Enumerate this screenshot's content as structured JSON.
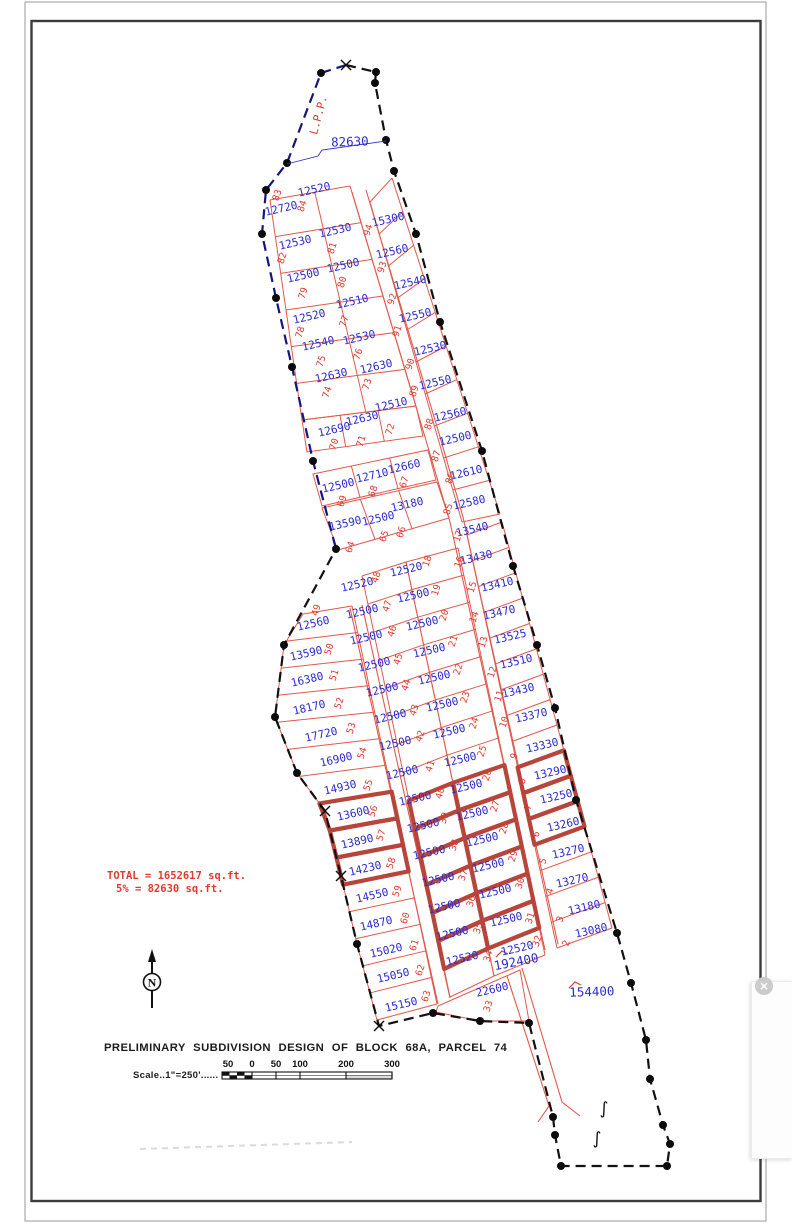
{
  "doc": {
    "title": "PRELIMINARY SUBDIVISION DESIGN OF BLOCK 68A, PARCEL 74",
    "scale_label": "Scale..1\"=250'......",
    "total_line1": "TOTAL = 1652617 sq.ft.",
    "total_line2": "5% = 82630 sq.ft.",
    "north_letter": "N",
    "lpp_label": "L.P.P.",
    "reserve_area": "82630",
    "road_parcel_area": "192400",
    "south_parcel_area": "154400",
    "close_icon": "×",
    "break_symbol": "∫"
  },
  "colors": {
    "line_red": "#e0594e",
    "bold_red": "#b8453b",
    "num_red": "#e03a30",
    "area_blue": "#2b2bcc",
    "boundary_black": "#111111",
    "boundary_blue": "#15157e",
    "border_dark": "#3b3b3b",
    "border_gray": "#9a9a9a"
  },
  "scalebar": {
    "labels": [
      "50",
      "0",
      "50",
      "100",
      "200",
      "300"
    ],
    "label_x": [
      228,
      252,
      276,
      300,
      346,
      392
    ],
    "tick_x": [
      252,
      276,
      300,
      346,
      392
    ],
    "x0": 222,
    "x1": 392,
    "y": 1072,
    "h": 7
  },
  "lots_key": [
    "lot_no",
    "area_sqft",
    "area_x",
    "area_y",
    "num_x",
    "num_y",
    "bold"
  ],
  "lots": [
    [
      "83",
      "12720",
      282,
      212,
      280,
      196,
      0
    ],
    [
      "84",
      "12520",
      315,
      193,
      305,
      207,
      0
    ],
    [
      "82",
      "12530",
      296,
      246,
      285,
      259,
      0
    ],
    [
      "81",
      "12530",
      336,
      234,
      335,
      249,
      0
    ],
    [
      "79",
      "12500",
      304,
      279,
      306,
      294,
      0
    ],
    [
      "80",
      "12500",
      344,
      269,
      345,
      283,
      0
    ],
    [
      "78",
      "12520",
      310,
      320,
      303,
      333,
      0
    ],
    [
      "77",
      "12510",
      353,
      305,
      347,
      322,
      0
    ],
    [
      "75",
      "12540",
      319,
      347,
      324,
      362,
      0
    ],
    [
      "76",
      "12530",
      360,
      341,
      361,
      355,
      0
    ],
    [
      "74",
      "12630",
      332,
      379,
      330,
      393,
      0
    ],
    [
      "73",
      "12630",
      377,
      370,
      370,
      385,
      0
    ],
    [
      "70",
      "12690",
      335,
      433,
      337,
      445,
      0
    ],
    [
      "71",
      "12630",
      363,
      422,
      364,
      442,
      0
    ],
    [
      "72",
      "12510",
      392,
      408,
      393,
      430,
      0
    ],
    [
      "69",
      "12500",
      339,
      489,
      345,
      502,
      0
    ],
    [
      "68",
      "12710",
      373,
      479,
      376,
      492,
      0
    ],
    [
      "67",
      "12660",
      405,
      470,
      407,
      483,
      0
    ],
    [
      "64",
      "13590",
      346,
      527,
      353,
      548,
      0
    ],
    [
      "65",
      "12500",
      379,
      522,
      387,
      537,
      0
    ],
    [
      "66",
      "13180",
      408,
      508,
      404,
      533,
      0
    ],
    [
      "94",
      "15300",
      389,
      223,
      371,
      231,
      0
    ],
    [
      "93",
      "12560",
      393,
      255,
      385,
      268,
      0
    ],
    [
      "92",
      "12540",
      411,
      286,
      395,
      300,
      0
    ],
    [
      "91",
      "12550",
      416,
      319,
      400,
      332,
      0
    ],
    [
      "90",
      "12530",
      431,
      352,
      413,
      365,
      0
    ],
    [
      "89",
      "12550",
      436,
      386,
      417,
      392,
      0
    ],
    [
      "88",
      "12560",
      451,
      418,
      432,
      425,
      0
    ],
    [
      "87",
      "12500",
      456,
      442,
      439,
      457,
      0
    ],
    [
      "86",
      "12610",
      467,
      476,
      453,
      479,
      0
    ],
    [
      "85",
      "12580",
      470,
      506,
      451,
      510,
      0
    ],
    [
      "17",
      "13540",
      473,
      533,
      461,
      537,
      0
    ],
    [
      "16",
      "13430",
      477,
      561,
      462,
      563,
      0
    ],
    [
      "15",
      "13410",
      498,
      588,
      475,
      588,
      0
    ],
    [
      "14",
      "13470",
      500,
      616,
      477,
      618,
      0
    ],
    [
      "13",
      "13525",
      511,
      640,
      486,
      643,
      0
    ],
    [
      "12",
      "13510",
      517,
      665,
      495,
      673,
      0
    ],
    [
      "11",
      "13430",
      519,
      694,
      502,
      697,
      0
    ],
    [
      "10",
      "13370",
      532,
      719,
      507,
      723,
      0
    ],
    [
      "9",
      "13330",
      543,
      749,
      517,
      757,
      0
    ],
    [
      "8",
      "13290",
      551,
      776,
      525,
      782,
      1
    ],
    [
      "7",
      "13250",
      557,
      800,
      531,
      808,
      1
    ],
    [
      "6",
      "13260",
      564,
      828,
      539,
      835,
      1
    ],
    [
      "5",
      "13270",
      569,
      855,
      546,
      862,
      0
    ],
    [
      "4",
      "13270",
      573,
      884,
      553,
      892,
      0
    ],
    [
      "3",
      "13180",
      585,
      911,
      563,
      920,
      0
    ],
    [
      "2",
      "13080",
      592,
      934,
      569,
      944,
      0
    ],
    [
      "49",
      "12560",
      314,
      627,
      319,
      611,
      0
    ],
    [
      "50",
      "13590",
      307,
      657,
      332,
      650,
      0
    ],
    [
      "51",
      "16380",
      308,
      683,
      337,
      676,
      0
    ],
    [
      "52",
      "18170",
      310,
      711,
      342,
      704,
      0
    ],
    [
      "53",
      "17720",
      322,
      738,
      354,
      729,
      0
    ],
    [
      "54",
      "16900",
      337,
      763,
      365,
      754,
      0
    ],
    [
      "55",
      "14930",
      341,
      791,
      371,
      786,
      0
    ],
    [
      "56",
      "13600",
      354,
      817,
      376,
      812,
      1
    ],
    [
      "57",
      "13890",
      358,
      845,
      384,
      836,
      1
    ],
    [
      "58",
      "14230",
      366,
      872,
      394,
      864,
      1
    ],
    [
      "59",
      "14550",
      373,
      899,
      400,
      892,
      0
    ],
    [
      "60",
      "14870",
      377,
      927,
      408,
      919,
      0
    ],
    [
      "61",
      "15020",
      387,
      954,
      417,
      946,
      0
    ],
    [
      "62",
      "15050",
      394,
      979,
      423,
      971,
      0
    ],
    [
      "63",
      "15150",
      402,
      1008,
      429,
      997,
      0
    ],
    [
      "48",
      "12520",
      358,
      588,
      379,
      578,
      0
    ],
    [
      "47",
      "12500",
      363,
      615,
      390,
      607,
      0
    ],
    [
      "46",
      "12500",
      367,
      641,
      395,
      632,
      0
    ],
    [
      "45",
      "12500",
      375,
      668,
      401,
      660,
      0
    ],
    [
      "44",
      "12500",
      383,
      693,
      409,
      686,
      0
    ],
    [
      "43",
      "12500",
      391,
      720,
      417,
      711,
      0
    ],
    [
      "42",
      "12500",
      396,
      747,
      423,
      737,
      0
    ],
    [
      "41",
      "12500",
      403,
      776,
      433,
      767,
      0
    ],
    [
      "40",
      "12500",
      416,
      802,
      443,
      794,
      1
    ],
    [
      "39",
      "12500",
      424,
      829,
      447,
      819,
      1
    ],
    [
      "38",
      "12500",
      430,
      856,
      457,
      846,
      1
    ],
    [
      "37",
      "12500",
      439,
      883,
      466,
      876,
      1
    ],
    [
      "36",
      "12500",
      445,
      910,
      474,
      902,
      1
    ],
    [
      "35",
      "12500",
      453,
      937,
      481,
      929,
      1
    ],
    [
      "34",
      "12520",
      463,
      962,
      491,
      957,
      0
    ],
    [
      "18",
      "12520",
      407,
      573,
      430,
      562,
      0
    ],
    [
      "19",
      "12500",
      414,
      599,
      439,
      591,
      0
    ],
    [
      "20",
      "12500",
      423,
      627,
      447,
      616,
      0
    ],
    [
      "21",
      "12500",
      430,
      654,
      456,
      642,
      0
    ],
    [
      "22",
      "12500",
      435,
      681,
      461,
      670,
      0
    ],
    [
      "23",
      "12500",
      443,
      708,
      468,
      698,
      0
    ],
    [
      "24",
      "12500",
      450,
      735,
      477,
      724,
      0
    ],
    [
      "25",
      "12500",
      461,
      763,
      485,
      752,
      0
    ],
    [
      "26",
      "12500",
      467,
      790,
      490,
      776,
      1
    ],
    [
      "27",
      "12500",
      473,
      817,
      498,
      807,
      1
    ],
    [
      "28",
      "12500",
      483,
      843,
      507,
      829,
      1
    ],
    [
      "29",
      "12500",
      489,
      869,
      516,
      857,
      1
    ],
    [
      "30",
      "12500",
      496,
      895,
      523,
      884,
      1
    ],
    [
      "31",
      "12500",
      507,
      923,
      533,
      919,
      1
    ],
    [
      "32",
      "12520",
      518,
      952,
      540,
      942,
      0
    ],
    [
      "33",
      "22600",
      493,
      993,
      491,
      1007,
      0
    ]
  ],
  "geometry": {
    "boundary_black": [
      [
        346,
        65
      ],
      [
        376,
        72
      ],
      [
        375,
        83
      ],
      [
        386,
        140
      ],
      [
        394,
        171
      ],
      [
        416,
        234
      ],
      [
        440,
        322
      ],
      [
        482,
        451
      ],
      [
        513,
        566
      ],
      [
        537,
        645
      ],
      [
        555,
        708
      ],
      [
        576,
        800
      ],
      [
        617,
        933
      ],
      [
        631,
        983
      ],
      [
        646,
        1040
      ],
      [
        650,
        1079
      ],
      [
        663,
        1125
      ],
      [
        670,
        1144
      ],
      [
        667,
        1166
      ],
      [
        561,
        1166
      ],
      [
        555,
        1135
      ],
      [
        553,
        1117
      ],
      [
        529,
        1023
      ],
      [
        480,
        1021
      ],
      [
        433,
        1013
      ],
      [
        379,
        1026
      ],
      [
        357,
        944
      ],
      [
        341,
        876
      ],
      [
        325,
        811
      ],
      [
        297,
        773
      ],
      [
        275,
        717
      ],
      [
        284,
        645
      ],
      [
        336,
        549
      ]
    ],
    "boundary_blue": [
      [
        346,
        65
      ],
      [
        321,
        73
      ],
      [
        287,
        163
      ],
      [
        266,
        190
      ],
      [
        262,
        234
      ],
      [
        276,
        298
      ],
      [
        292,
        367
      ],
      [
        313,
        461
      ],
      [
        336,
        549
      ]
    ],
    "dots": [
      [
        321,
        73
      ],
      [
        376,
        72
      ],
      [
        375,
        83
      ],
      [
        386,
        140
      ],
      [
        394,
        171
      ],
      [
        416,
        234
      ],
      [
        440,
        322
      ],
      [
        482,
        451
      ],
      [
        513,
        566
      ],
      [
        537,
        645
      ],
      [
        555,
        708
      ],
      [
        576,
        800
      ],
      [
        617,
        933
      ],
      [
        631,
        983
      ],
      [
        646,
        1040
      ],
      [
        650,
        1079
      ],
      [
        663,
        1125
      ],
      [
        670,
        1144
      ],
      [
        667,
        1166
      ],
      [
        561,
        1166
      ],
      [
        555,
        1135
      ],
      [
        553,
        1117
      ],
      [
        529,
        1023
      ],
      [
        480,
        1021
      ],
      [
        433,
        1013
      ],
      [
        357,
        944
      ],
      [
        297,
        773
      ],
      [
        275,
        717
      ],
      [
        284,
        645
      ],
      [
        336,
        549
      ],
      [
        313,
        461
      ],
      [
        292,
        367
      ],
      [
        276,
        298
      ],
      [
        262,
        234
      ],
      [
        266,
        190
      ],
      [
        287,
        163
      ]
    ],
    "xmarks": [
      [
        346,
        65
      ],
      [
        379,
        1026
      ],
      [
        341,
        876
      ],
      [
        325,
        811
      ]
    ],
    "strips": [
      {
        "id": "u12",
        "L0": [
          270,
          200
        ],
        "L1": [
          302,
          420
        ],
        "R0": [
          350,
          186
        ],
        "R1": [
          416,
          406
        ],
        "n": 6,
        "divider": 0.56
      },
      {
        "id": "r3",
        "quad": [
          [
            302,
            420
          ],
          [
            416,
            406
          ],
          [
            423,
            436
          ],
          [
            307,
            452
          ]
        ],
        "cols": 3
      },
      {
        "id": "r4",
        "quad": [
          [
            313,
            474
          ],
          [
            428,
            450
          ],
          [
            436,
            480
          ],
          [
            322,
            506
          ]
        ],
        "cols": 3
      },
      {
        "id": "r5",
        "quad": [
          [
            322,
            508
          ],
          [
            437,
            482
          ],
          [
            449,
            518
          ],
          [
            338,
            550
          ]
        ],
        "cols": 3
      },
      {
        "id": "s3",
        "L0": [
          370,
          202
        ],
        "L1": [
          462,
          522
        ],
        "R0": [
          392,
          178
        ],
        "R1": [
          500,
          514
        ],
        "n": 10
      },
      {
        "id": "s4",
        "L0": [
          467,
          535
        ],
        "L1": [
          557,
          948
        ],
        "R0": [
          502,
          522
        ],
        "R1": [
          612,
          928
        ],
        "n": 16,
        "bold": [
          9,
          10,
          11
        ]
      },
      {
        "id": "s5",
        "leftPoly": [
          [
            303,
            614
          ],
          [
            284,
            645
          ],
          [
            275,
            717
          ],
          [
            297,
            773
          ],
          [
            325,
            811
          ],
          [
            341,
            876
          ],
          [
            357,
            944
          ],
          [
            377,
            1020
          ]
        ],
        "R0": [
          352,
          606
        ],
        "R1": [
          437,
          1004
        ],
        "n": 15,
        "bold": [
          7,
          8,
          9
        ]
      },
      {
        "id": "s6",
        "L0": [
          362,
          576
        ],
        "L1": [
          450,
          997
        ],
        "R0": [
          406,
          562
        ],
        "R1": [
          494,
          976
        ],
        "n": 15,
        "bold": [
          8,
          9,
          10,
          11,
          12,
          13
        ]
      },
      {
        "id": "s7",
        "L0": [
          406,
          562
        ],
        "L1": [
          494,
          976
        ],
        "R0": [
          458,
          548
        ],
        "R1": [
          545,
          955
        ],
        "n": 15,
        "bold": [
          8,
          9,
          10,
          11,
          12,
          13
        ]
      }
    ],
    "streets": [
      [
        [
          352,
          192
        ],
        [
          425,
          437
        ],
        [
          450,
          522
        ],
        [
          545,
          950
        ]
      ],
      [
        [
          366,
          190
        ],
        [
          438,
          430
        ],
        [
          463,
          517
        ],
        [
          558,
          944
        ]
      ],
      [
        [
          350,
          608
        ],
        [
          438,
          1004
        ]
      ],
      [
        [
          362,
          605
        ],
        [
          450,
          998
        ]
      ],
      [
        [
          507,
          976
        ],
        [
          549,
          1106
        ],
        [
          538,
          1122
        ]
      ],
      [
        [
          522,
          968
        ],
        [
          562,
          1102
        ],
        [
          580,
          1116
        ]
      ]
    ],
    "lot33_poly": [
      [
        438,
        1006
      ],
      [
        520,
        970
      ],
      [
        529,
        1021
      ],
      [
        480,
        1021
      ],
      [
        436,
        1012
      ]
    ],
    "leader_82630": [
      [
        287,
        164
      ],
      [
        318,
        156
      ],
      [
        322,
        150
      ],
      [
        386,
        141
      ]
    ],
    "red_ticks": [
      [
        [
          496,
          957
        ],
        [
          502,
          951
        ],
        [
          508,
          954
        ]
      ],
      [
        [
          569,
          988
        ],
        [
          575,
          982
        ],
        [
          581,
          985
        ]
      ]
    ],
    "label_pos": {
      "lpp": [
        322,
        116,
        -75
      ],
      "reserve": [
        350,
        146,
        -2
      ],
      "road_parcel": [
        517,
        966,
        -11
      ],
      "south_parcel": [
        592,
        996,
        -2
      ],
      "north_cx": 152,
      "north_cy": 982,
      "breaks": [
        [
          604,
          1114
        ],
        [
          597,
          1144
        ]
      ]
    },
    "borders": {
      "outer": [
        25,
        2,
        741,
        1219
      ],
      "inner": [
        31.5,
        21,
        729,
        1180
      ]
    }
  }
}
